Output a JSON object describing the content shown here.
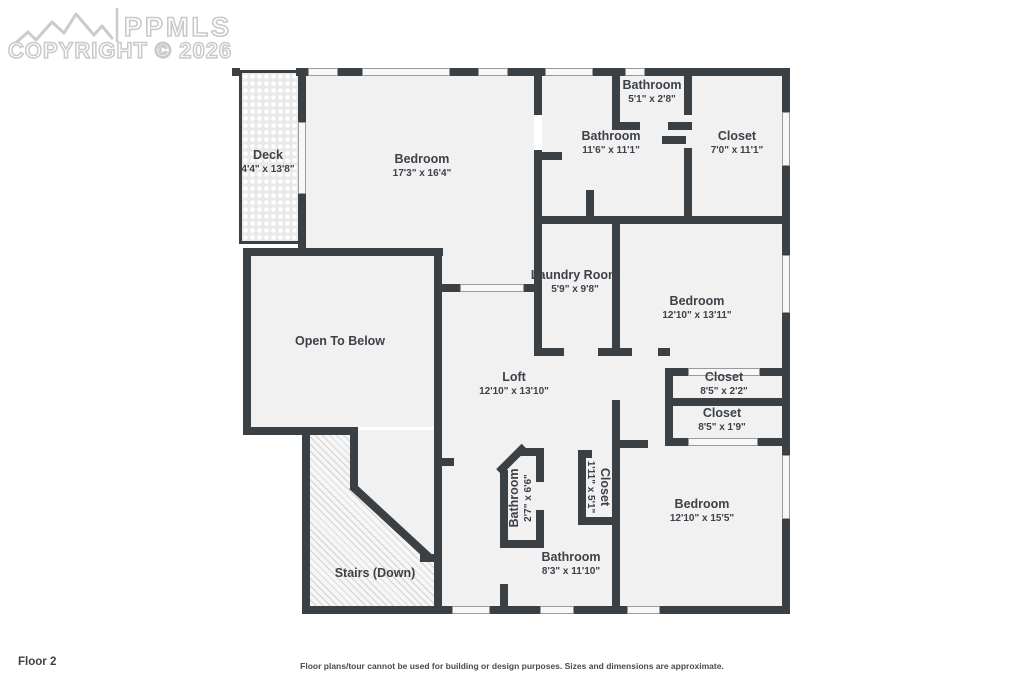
{
  "watermark": {
    "brand": "PPMLS",
    "copyright": "COPYRIGHT © 2026"
  },
  "footer": {
    "floor_label": "Floor 2",
    "disclaimer": "Floor plans/tour cannot be used for building or design purposes. Sizes and dimensions are approximate."
  },
  "rooms": [
    {
      "id": "deck",
      "name": "Deck",
      "dims": "4'4\" x 13'8\""
    },
    {
      "id": "bedroom-top",
      "name": "Bedroom",
      "dims": "17'3\" x 16'4\""
    },
    {
      "id": "bathroom-small-top",
      "name": "Bathroom",
      "dims": "5'1\" x 2'8\""
    },
    {
      "id": "bathroom-top",
      "name": "Bathroom",
      "dims": "11'6\" x 11'1\""
    },
    {
      "id": "closet-top",
      "name": "Closet",
      "dims": "7'0\" x 11'1\""
    },
    {
      "id": "laundry-room",
      "name": "Laundry Room",
      "dims": "5'9\" x 9'8\""
    },
    {
      "id": "bedroom-right",
      "name": "Bedroom",
      "dims": "12'10\" x 13'11\""
    },
    {
      "id": "open-to-below",
      "name": "Open To Below",
      "dims": ""
    },
    {
      "id": "loft",
      "name": "Loft",
      "dims": "12'10\" x 13'10\""
    },
    {
      "id": "closet-mid-upper",
      "name": "Closet",
      "dims": "8'5\" x 2'2\""
    },
    {
      "id": "closet-mid-lower",
      "name": "Closet",
      "dims": "8'5\" x 1'9\""
    },
    {
      "id": "closet-small",
      "name": "Closet",
      "dims": "1'11\" x 5'1\""
    },
    {
      "id": "bathroom-small-mid",
      "name": "Bathroom",
      "dims": "2'7\" x 6'6\""
    },
    {
      "id": "bathroom-bottom",
      "name": "Bathroom",
      "dims": "8'3\" x 11'10\""
    },
    {
      "id": "bedroom-bottom",
      "name": "Bedroom",
      "dims": "12'10\" x 15'5\""
    },
    {
      "id": "stairs",
      "name": "Stairs (Down)",
      "dims": ""
    }
  ],
  "colors": {
    "wall": "#3b4045",
    "floor": "#f1f1f2",
    "label": "#3d4248",
    "watermark": "#c9c9c9"
  }
}
